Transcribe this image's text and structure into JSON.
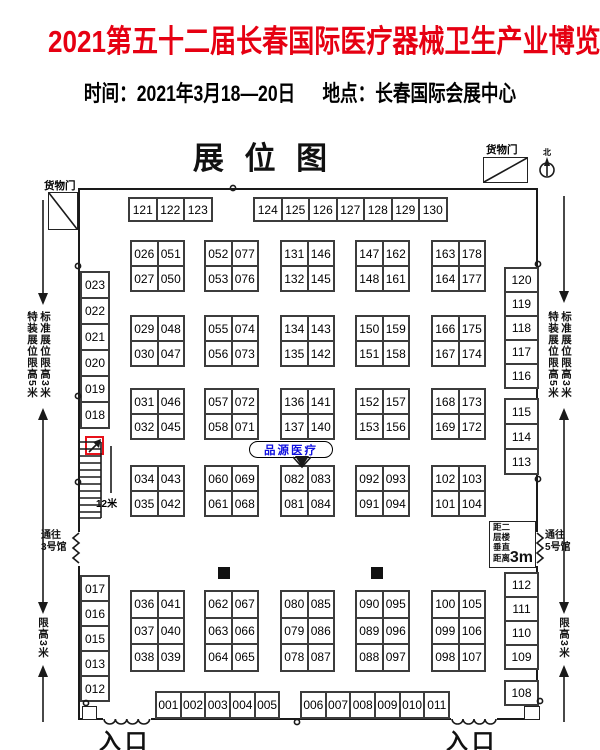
{
  "colors": {
    "title_red": "#e60012",
    "callout_blue": "#1010e0",
    "marker_red": "#e8111a"
  },
  "header": {
    "title": "2021第五十二届长春国际医疗器械卫生产业博览会",
    "time_label": "时间：",
    "time_value": "2021年3月18—20日",
    "place_label": "地点：",
    "place_value": "长春国际会展中心",
    "plan_title": "展 位 图"
  },
  "annotations": {
    "cargo_door": "货物门",
    "north": "北",
    "stairs_width": "12米",
    "to_hall_3": [
      "通往",
      "3号馆"
    ],
    "to_hall_5": [
      "通往",
      "5号馆"
    ],
    "floor_note": {
      "lines": [
        "距二",
        "层楼",
        "垂直",
        "距离"
      ],
      "value": "3m"
    },
    "special_limit": "特装展位限高5米",
    "standard_limit": "标准展位限高3米",
    "height_limit": "限高3米",
    "entrance": "入口",
    "callout_exhibitor": "品源医疗"
  },
  "booths": {
    "top_group1": [
      "121",
      "122",
      "123"
    ],
    "top_group2": [
      "124",
      "125",
      "126",
      "127",
      "128",
      "129",
      "130"
    ],
    "left_top": [
      "023",
      "022",
      "021",
      "020",
      "019",
      "018"
    ],
    "left_bottom": [
      "017",
      "016",
      "015",
      "013",
      "012"
    ],
    "right_top": [
      "120",
      "119",
      "118",
      "117",
      "116"
    ],
    "right_mid": [
      "115",
      "114",
      "113"
    ],
    "right_bottom": [
      "112",
      "111",
      "110",
      "109"
    ],
    "right_corner": [
      "108"
    ],
    "bottom_group1": [
      "001",
      "002",
      "003",
      "004",
      "005"
    ],
    "bottom_group2": [
      "006",
      "007",
      "008",
      "009",
      "010",
      "011"
    ],
    "main": [
      [
        [
          [
            "026",
            "051"
          ],
          [
            "027",
            "050"
          ]
        ],
        [
          [
            "052",
            "077"
          ],
          [
            "053",
            "076"
          ]
        ],
        [
          [
            "131",
            "146"
          ],
          [
            "132",
            "145"
          ]
        ],
        [
          [
            "147",
            "162"
          ],
          [
            "148",
            "161"
          ]
        ],
        [
          [
            "163",
            "178"
          ],
          [
            "164",
            "177"
          ]
        ]
      ],
      [
        [
          [
            "029",
            "048"
          ],
          [
            "030",
            "047"
          ]
        ],
        [
          [
            "055",
            "074"
          ],
          [
            "056",
            "073"
          ]
        ],
        [
          [
            "134",
            "143"
          ],
          [
            "135",
            "142"
          ]
        ],
        [
          [
            "150",
            "159"
          ],
          [
            "151",
            "158"
          ]
        ],
        [
          [
            "166",
            "175"
          ],
          [
            "167",
            "174"
          ]
        ]
      ],
      [
        [
          [
            "031",
            "046"
          ],
          [
            "032",
            "045"
          ]
        ],
        [
          [
            "057",
            "072"
          ],
          [
            "058",
            "071"
          ]
        ],
        [
          [
            "136",
            "141"
          ],
          [
            "137",
            "140"
          ]
        ],
        [
          [
            "152",
            "157"
          ],
          [
            "153",
            "156"
          ]
        ],
        [
          [
            "168",
            "173"
          ],
          [
            "169",
            "172"
          ]
        ]
      ],
      [
        [
          [
            "034",
            "043"
          ],
          [
            "035",
            "042"
          ]
        ],
        [
          [
            "060",
            "069"
          ],
          [
            "061",
            "068"
          ]
        ],
        [
          [
            "082",
            "083"
          ],
          [
            "081",
            "084"
          ]
        ],
        [
          [
            "092",
            "093"
          ],
          [
            "091",
            "094"
          ]
        ],
        [
          [
            "102",
            "103"
          ],
          [
            "101",
            "104"
          ]
        ]
      ]
    ],
    "lower": [
      [
        [
          "036",
          "041"
        ],
        [
          "037",
          "040"
        ],
        [
          "038",
          "039"
        ]
      ],
      [
        [
          "062",
          "067"
        ],
        [
          "063",
          "066"
        ],
        [
          "064",
          "065"
        ]
      ],
      [
        [
          "080",
          "085"
        ],
        [
          "079",
          "086"
        ],
        [
          "078",
          "087"
        ]
      ],
      [
        [
          "090",
          "095"
        ],
        [
          "089",
          "096"
        ],
        [
          "088",
          "097"
        ]
      ],
      [
        [
          "100",
          "105"
        ],
        [
          "099",
          "106"
        ],
        [
          "098",
          "107"
        ]
      ]
    ]
  }
}
